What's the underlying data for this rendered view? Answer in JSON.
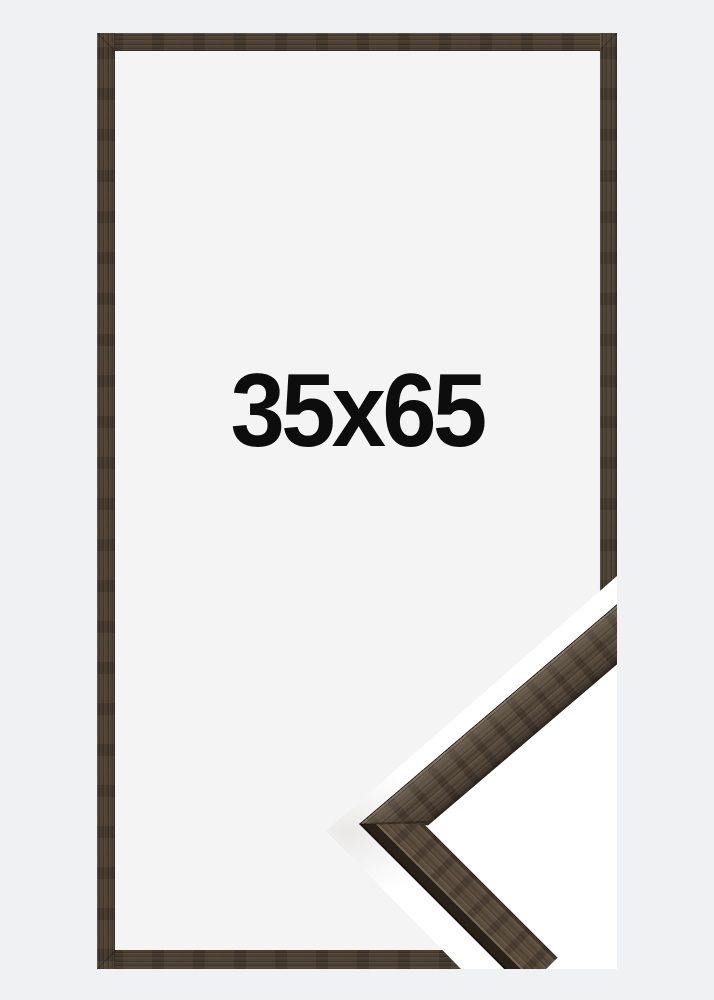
{
  "product": {
    "size_label": "35x65",
    "photo_kind": "picture frame product photo: flat front view with mitered corner profile sample",
    "material_appearance": "dark brown walnut wood grain",
    "colors": {
      "background": "#f0f1f2",
      "opening": "#f4f4f5",
      "knockout": "#ffffff",
      "wood_base": "#473c30",
      "wood_dark": "#352c23",
      "wood_light": "#5d5041",
      "corner_face": "#4f4336",
      "corner_top_face": "#55483a",
      "corner_side": "#2a231b",
      "label_ink": "#0d0d0d"
    }
  }
}
